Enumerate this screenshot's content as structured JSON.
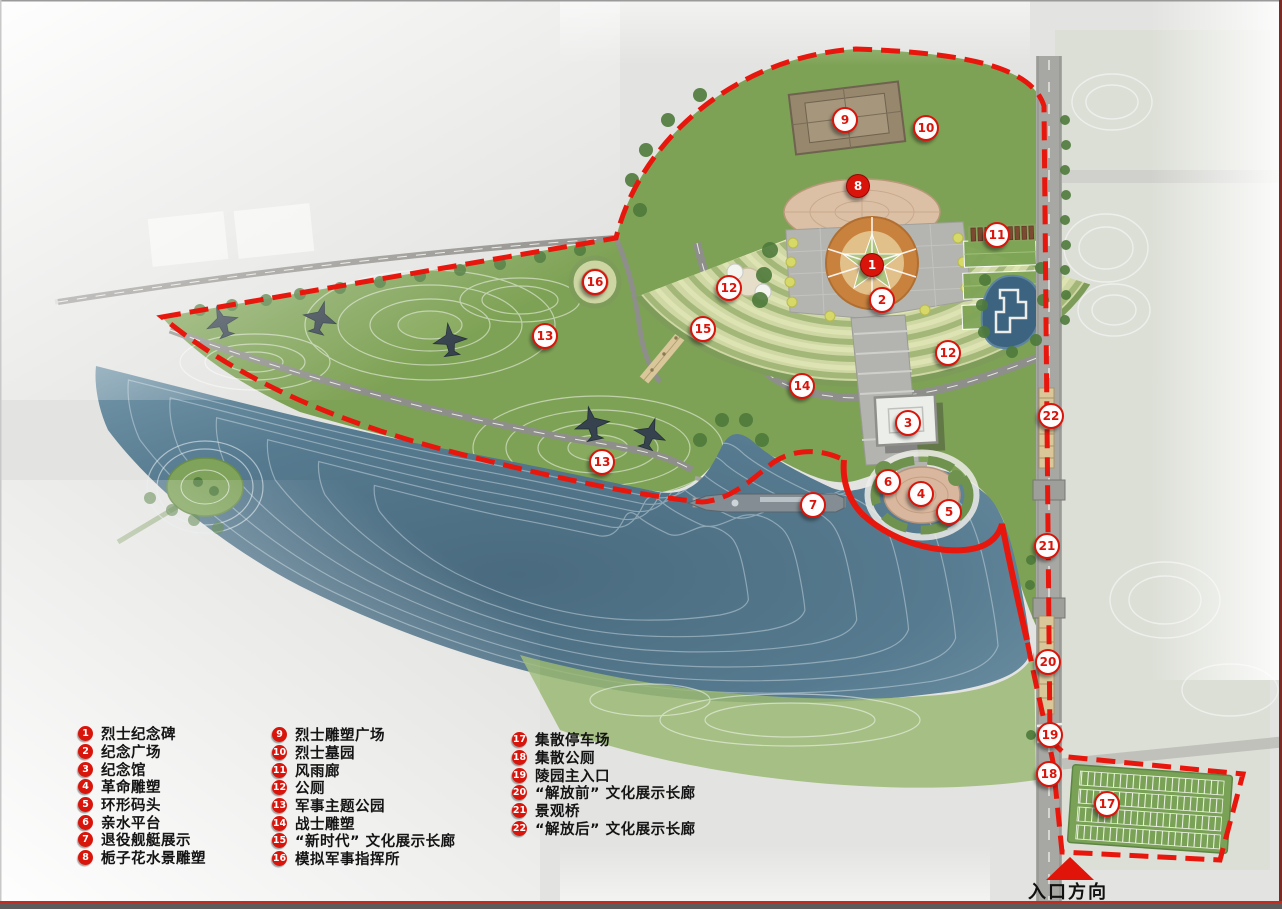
{
  "page": {
    "width": 1282,
    "height": 909,
    "background": "#e3e3e1"
  },
  "legend": {
    "marker_bg": "#d9150b",
    "text_color": "#141414",
    "columns": [
      {
        "items": [
          {
            "num": "1",
            "label": "烈士纪念碑"
          },
          {
            "num": "2",
            "label": "纪念广场"
          },
          {
            "num": "3",
            "label": "纪念馆"
          },
          {
            "num": "4",
            "label": "革命雕塑"
          },
          {
            "num": "5",
            "label": "环形码头"
          },
          {
            "num": "6",
            "label": "亲水平台"
          },
          {
            "num": "7",
            "label": "退役舰艇展示"
          },
          {
            "num": "8",
            "label": "栀子花水景雕塑"
          }
        ]
      },
      {
        "items": [
          {
            "num": "9",
            "label": "烈士雕塑广场"
          },
          {
            "num": "10",
            "label": "烈士墓园"
          },
          {
            "num": "11",
            "label": "风雨廊"
          },
          {
            "num": "12",
            "label": "公厕"
          },
          {
            "num": "13",
            "label": "军事主题公园"
          },
          {
            "num": "14",
            "label": "战士雕塑"
          },
          {
            "num": "15",
            "label": "“新时代” 文化展示长廊"
          },
          {
            "num": "16",
            "label": "模拟军事指挥所"
          }
        ]
      },
      {
        "items": [
          {
            "num": "17",
            "label": "集散停车场"
          },
          {
            "num": "18",
            "label": "集散公厕"
          },
          {
            "num": "19",
            "label": "陵园主入口"
          },
          {
            "num": "20",
            "label": "“解放前” 文化展示长廊"
          },
          {
            "num": "21",
            "label": "景观桥"
          },
          {
            "num": "22",
            "label": "“解放后” 文化展示长廊"
          }
        ]
      }
    ]
  },
  "entrance": {
    "label": "入口方向",
    "arrow_color": "#e01408",
    "text_color": "#111111"
  },
  "map": {
    "boundary_color": "#e8170d",
    "marker_outline": {
      "bg": "#fdfdfd",
      "border": "#d9150b",
      "text": "#d9150b"
    },
    "marker_solid": {
      "bg": "#d9150b",
      "text": "#ffffff"
    },
    "markers": [
      {
        "num": "1",
        "x": 872,
        "y": 265,
        "style": "solid",
        "title": "烈士纪念碑"
      },
      {
        "num": "2",
        "x": 882,
        "y": 300,
        "style": "outline",
        "title": "纪念广场"
      },
      {
        "num": "3",
        "x": 908,
        "y": 423,
        "style": "outline",
        "title": "纪念馆"
      },
      {
        "num": "4",
        "x": 921,
        "y": 494,
        "style": "outline",
        "title": "革命雕塑"
      },
      {
        "num": "5",
        "x": 949,
        "y": 512,
        "style": "outline",
        "title": "环形码头"
      },
      {
        "num": "6",
        "x": 888,
        "y": 482,
        "style": "outline",
        "title": "亲水平台"
      },
      {
        "num": "7",
        "x": 813,
        "y": 505,
        "style": "outline",
        "title": "退役舰艇展示"
      },
      {
        "num": "8",
        "x": 858,
        "y": 186,
        "style": "solid",
        "title": "栀子花水景雕塑"
      },
      {
        "num": "9",
        "x": 845,
        "y": 120,
        "style": "outline",
        "title": "烈士雕塑广场"
      },
      {
        "num": "10",
        "x": 926,
        "y": 128,
        "style": "outline",
        "title": "烈士墓园"
      },
      {
        "num": "11",
        "x": 997,
        "y": 235,
        "style": "outline",
        "title": "风雨廊"
      },
      {
        "num": "12",
        "x": 729,
        "y": 288,
        "style": "outline",
        "title": "公厕"
      },
      {
        "num": "12",
        "x": 948,
        "y": 353,
        "style": "outline",
        "title": "公厕"
      },
      {
        "num": "13",
        "x": 545,
        "y": 336,
        "style": "outline",
        "title": "军事主题公园"
      },
      {
        "num": "13",
        "x": 602,
        "y": 462,
        "style": "outline",
        "title": "军事主题公园"
      },
      {
        "num": "14",
        "x": 802,
        "y": 386,
        "style": "outline",
        "title": "战士雕塑"
      },
      {
        "num": "15",
        "x": 703,
        "y": 329,
        "style": "outline",
        "title": "“新时代” 文化展示长廊"
      },
      {
        "num": "16",
        "x": 595,
        "y": 282,
        "style": "outline",
        "title": "模拟军事指挥所"
      },
      {
        "num": "17",
        "x": 1107,
        "y": 804,
        "style": "outline",
        "title": "集散停车场"
      },
      {
        "num": "18",
        "x": 1049,
        "y": 774,
        "style": "outline",
        "title": "集散公厕"
      },
      {
        "num": "19",
        "x": 1050,
        "y": 735,
        "style": "outline",
        "title": "陵园主入口"
      },
      {
        "num": "20",
        "x": 1048,
        "y": 662,
        "style": "outline",
        "title": "“解放前” 文化展示长廊"
      },
      {
        "num": "21",
        "x": 1047,
        "y": 546,
        "style": "outline",
        "title": "景观桥"
      },
      {
        "num": "22",
        "x": 1051,
        "y": 416,
        "style": "outline",
        "title": "“解放后” 文化展示长廊"
      }
    ]
  },
  "colors": {
    "boundary_red": "#e8170d",
    "lake_blue": "#55798e",
    "park_green": "#7ea255",
    "cemetery_light": "#cfd8a4",
    "plaza_gray": "#b4b4b0",
    "monument_orange": "#c9813e",
    "pond_blue": "#3c6480",
    "parking_green": "#7aa257",
    "corridor_tan": "#d9c79a"
  }
}
